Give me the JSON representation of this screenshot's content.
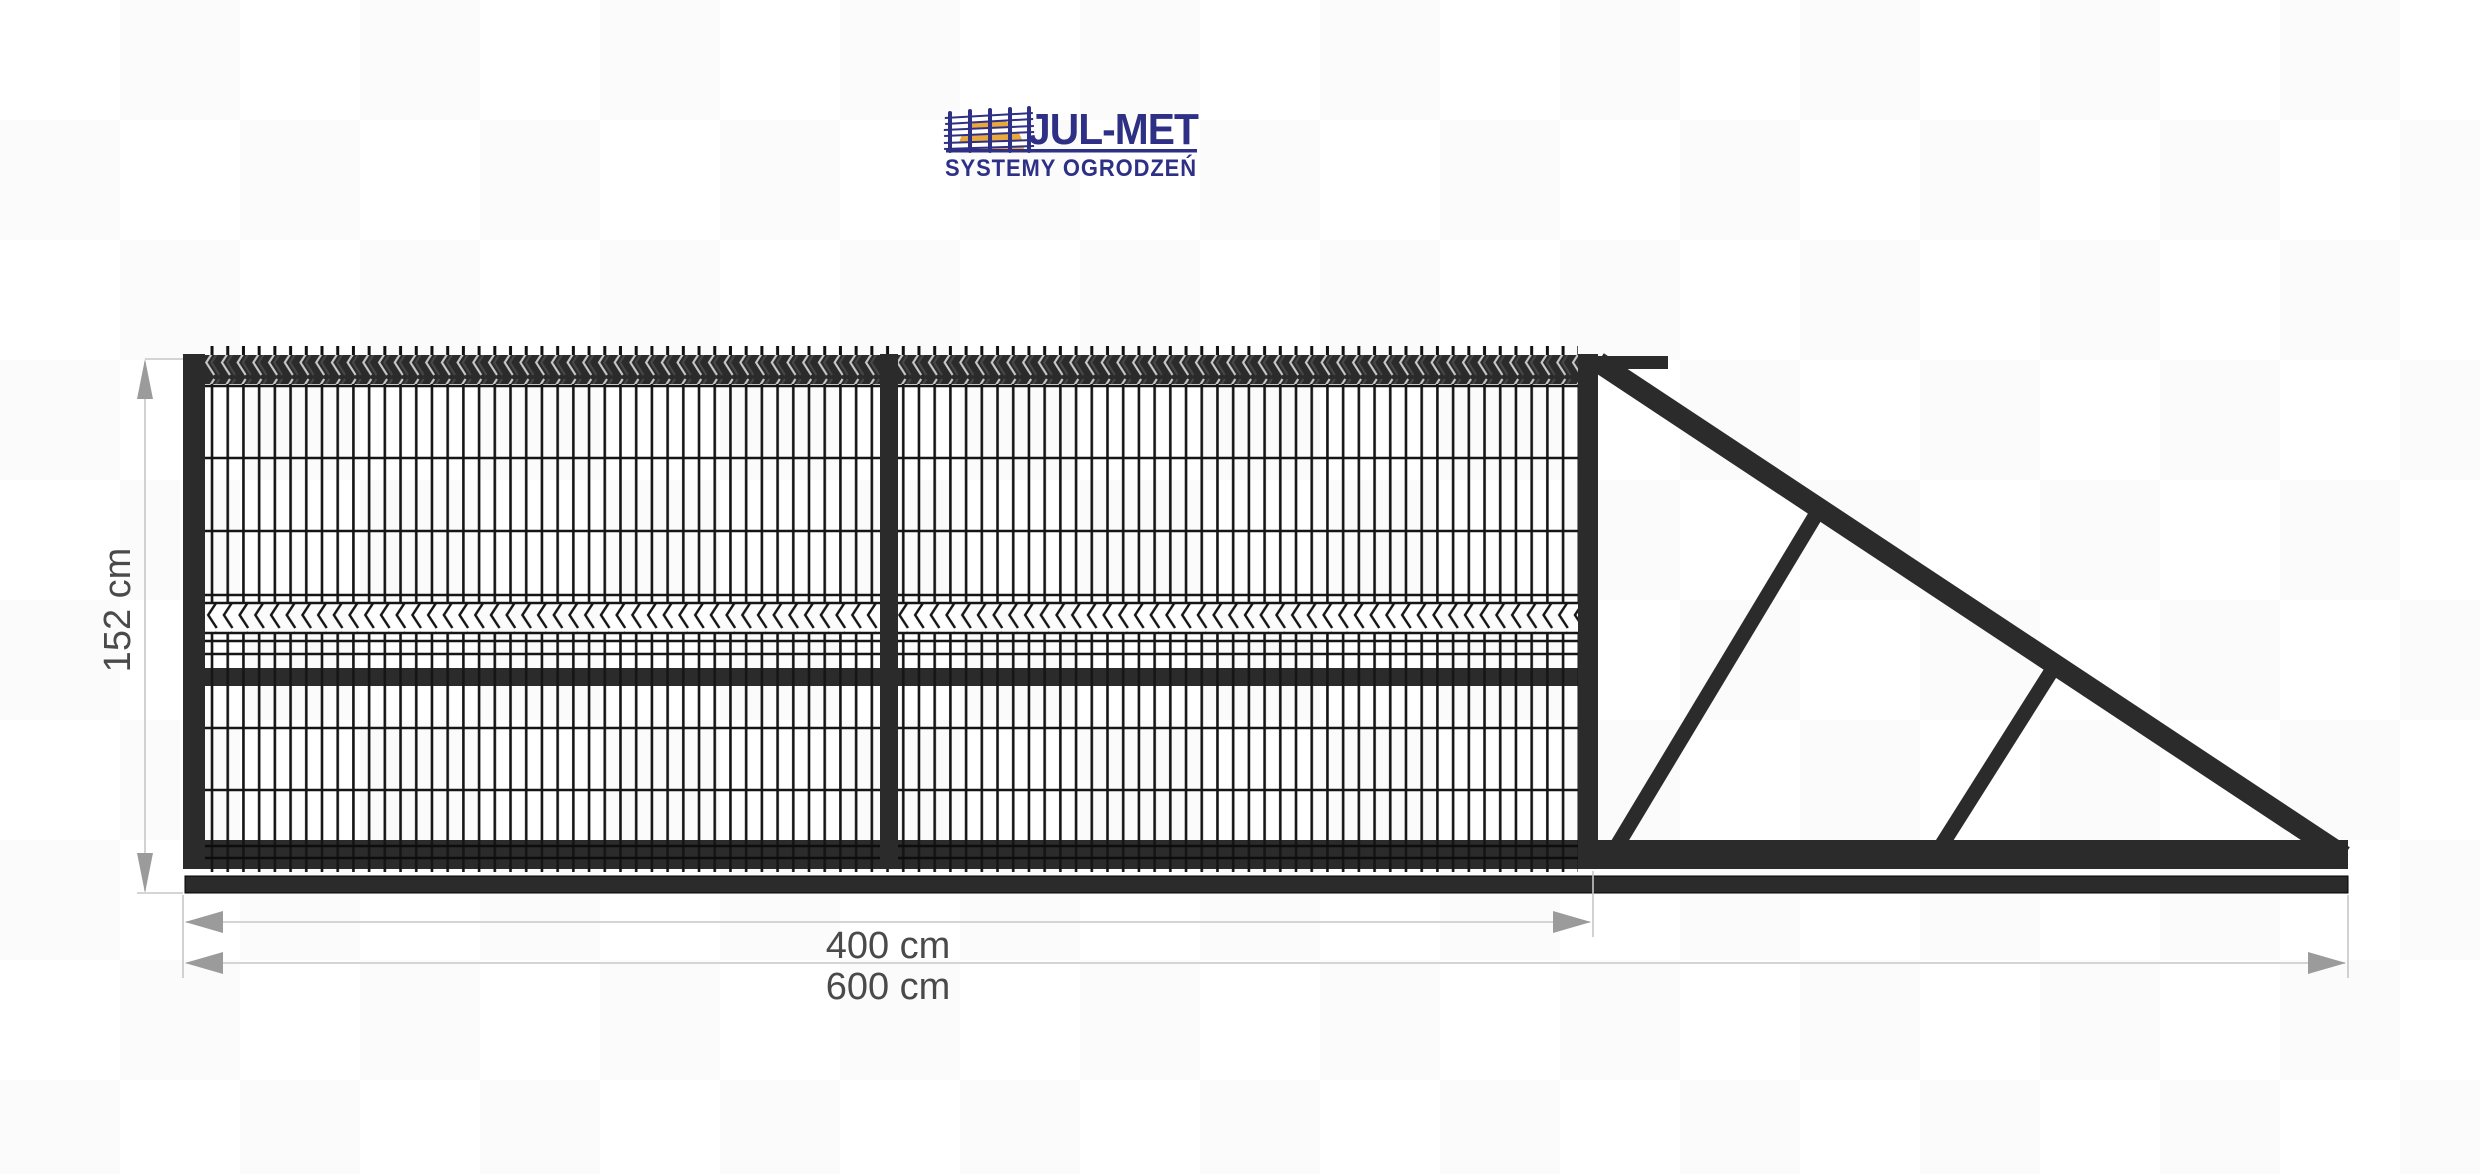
{
  "logo": {
    "title": "JUL-MET",
    "subtitle": "SYSTEMY OGRODZEŃ",
    "navy": "#2e3086",
    "sun": "#e9a83c"
  },
  "drawing": {
    "frame_color": "#2b2b2b",
    "wire_color": "#151515",
    "dim_line_color": "#c7c7c7",
    "dim_arrow_color": "#9b9b9b",
    "dim_text_color": "#4a4a4a"
  },
  "dimensions": {
    "height_label": "152 cm",
    "gate_width_label": "400 cm",
    "total_width_label": "600 cm"
  }
}
